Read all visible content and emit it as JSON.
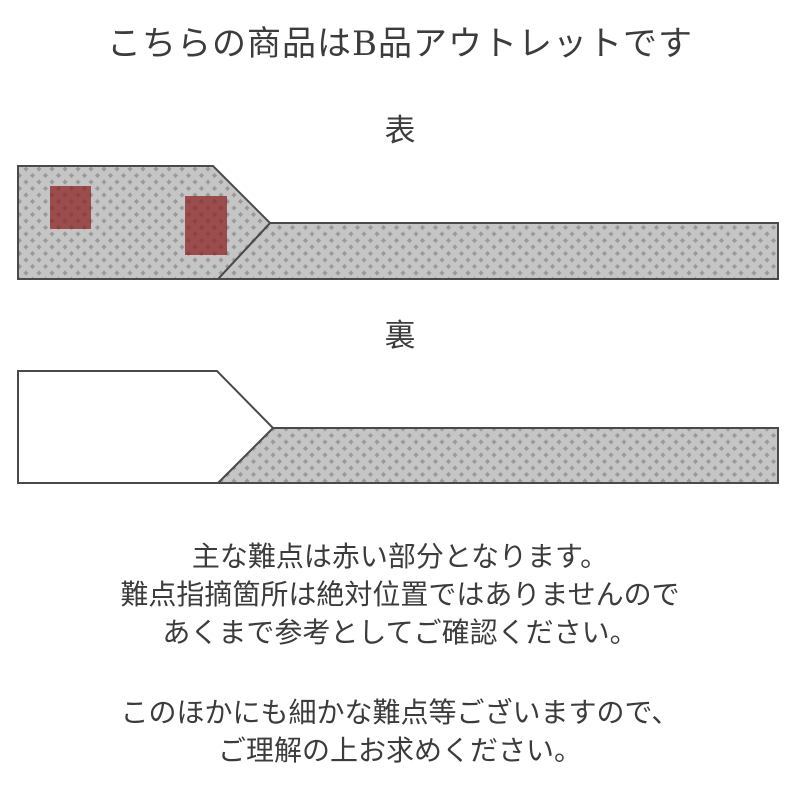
{
  "title": "こちらの商品はB品アウトレットです",
  "front": {
    "label": "表",
    "defects": [
      {
        "x": 50,
        "y": 186,
        "w": 41,
        "h": 43
      },
      {
        "x": 185,
        "y": 196,
        "w": 42,
        "h": 59
      }
    ]
  },
  "back": {
    "label": "裏"
  },
  "notes": [
    {
      "lines": [
        "主な難点は赤い部分となります。",
        "難点指摘箇所は絶対位置ではありませんので",
        "あくまで参考としてご確認ください。"
      ]
    },
    {
      "lines": [
        "このほかにも細かな難点等ございますので、",
        "ご理解の上お求めください。"
      ]
    }
  ],
  "colors": {
    "text": "#3c3c3c",
    "outline": "#4a4a4a",
    "pattern_background": "#999999",
    "pattern_motif": "#c5c5c5",
    "defect_red": "#8a1f1f",
    "back_face_white": "#ffffff"
  }
}
